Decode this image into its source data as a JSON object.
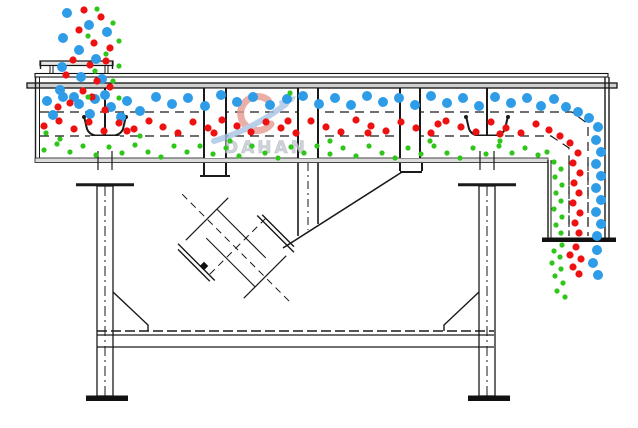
{
  "diagram": {
    "type": "linear-vibrating-screen-schematic",
    "watermark": {
      "brand": "DAHAN",
      "registered_mark": "®"
    }
  },
  "colors": {
    "line": "#1a1a1a",
    "watermark_text": "#c3c8d0",
    "watermark_red": "#e59a92",
    "watermark_blue": "#a8c4e4"
  },
  "particles": {
    "blue": {
      "radius": 5,
      "color": "#2f9ce8",
      "points": [
        [
          67,
          13
        ],
        [
          89,
          25
        ],
        [
          63,
          38
        ],
        [
          107,
          32
        ],
        [
          79,
          50
        ],
        [
          96,
          59
        ],
        [
          62,
          67
        ],
        [
          81,
          77
        ],
        [
          102,
          79
        ],
        [
          60,
          90
        ],
        [
          74,
          97
        ],
        [
          47,
          101
        ],
        [
          63,
          97
        ],
        [
          79,
          104
        ],
        [
          95,
          99
        ],
        [
          111,
          107
        ],
        [
          127,
          101
        ],
        [
          53,
          115
        ],
        [
          90,
          114
        ],
        [
          121,
          117
        ],
        [
          140,
          111
        ],
        [
          105,
          95
        ],
        [
          156,
          97
        ],
        [
          172,
          104
        ],
        [
          188,
          98
        ],
        [
          205,
          106
        ],
        [
          221,
          95
        ],
        [
          237,
          102
        ],
        [
          253,
          97
        ],
        [
          270,
          105
        ],
        [
          287,
          99
        ],
        [
          303,
          96
        ],
        [
          319,
          104
        ],
        [
          335,
          98
        ],
        [
          351,
          105
        ],
        [
          367,
          96
        ],
        [
          383,
          102
        ],
        [
          399,
          98
        ],
        [
          415,
          105
        ],
        [
          431,
          96
        ],
        [
          447,
          103
        ],
        [
          463,
          98
        ],
        [
          479,
          106
        ],
        [
          495,
          97
        ],
        [
          511,
          103
        ],
        [
          527,
          98
        ],
        [
          541,
          106
        ],
        [
          554,
          99
        ],
        [
          566,
          107
        ],
        [
          578,
          112
        ],
        [
          589,
          118
        ],
        [
          598,
          127
        ],
        [
          596,
          140
        ],
        [
          601,
          152
        ],
        [
          596,
          164
        ],
        [
          601,
          176
        ],
        [
          596,
          188
        ],
        [
          601,
          200
        ],
        [
          596,
          212
        ],
        [
          601,
          224
        ],
        [
          597,
          236
        ],
        [
          597,
          250
        ],
        [
          593,
          263
        ],
        [
          598,
          275
        ]
      ]
    },
    "red": {
      "radius": 3.6,
      "color": "#ee1111",
      "points": [
        [
          84,
          10
        ],
        [
          101,
          17
        ],
        [
          79,
          30
        ],
        [
          94,
          43
        ],
        [
          110,
          48
        ],
        [
          73,
          60
        ],
        [
          90,
          65
        ],
        [
          106,
          61
        ],
        [
          66,
          75
        ],
        [
          97,
          81
        ],
        [
          83,
          91
        ],
        [
          110,
          87
        ],
        [
          70,
          103
        ],
        [
          92,
          97
        ],
        [
          58,
          107
        ],
        [
          105,
          110
        ],
        [
          44,
          126
        ],
        [
          59,
          121
        ],
        [
          74,
          129
        ],
        [
          89,
          122
        ],
        [
          104,
          131
        ],
        [
          119,
          123
        ],
        [
          134,
          129
        ],
        [
          149,
          121
        ],
        [
          163,
          127
        ],
        [
          178,
          133
        ],
        [
          193,
          122
        ],
        [
          208,
          128
        ],
        [
          222,
          120
        ],
        [
          237,
          126
        ],
        [
          251,
          132
        ],
        [
          266,
          122
        ],
        [
          281,
          128
        ],
        [
          296,
          133
        ],
        [
          311,
          121
        ],
        [
          326,
          127
        ],
        [
          341,
          132
        ],
        [
          356,
          120
        ],
        [
          371,
          126
        ],
        [
          386,
          131
        ],
        [
          401,
          122
        ],
        [
          416,
          128
        ],
        [
          431,
          133
        ],
        [
          446,
          121
        ],
        [
          461,
          127
        ],
        [
          476,
          132
        ],
        [
          491,
          122
        ],
        [
          506,
          128
        ],
        [
          521,
          133
        ],
        [
          536,
          124
        ],
        [
          549,
          130
        ],
        [
          127,
          131
        ],
        [
          214,
          133
        ],
        [
          288,
          121
        ],
        [
          368,
          133
        ],
        [
          438,
          124
        ],
        [
          500,
          134
        ],
        [
          560,
          136
        ],
        [
          570,
          143
        ],
        [
          578,
          153
        ],
        [
          573,
          163
        ],
        [
          580,
          173
        ],
        [
          574,
          183
        ],
        [
          579,
          193
        ],
        [
          573,
          203
        ],
        [
          580,
          213
        ],
        [
          575,
          223
        ],
        [
          579,
          233
        ],
        [
          576,
          247
        ],
        [
          570,
          255
        ],
        [
          581,
          259
        ],
        [
          573,
          267
        ],
        [
          579,
          274
        ]
      ]
    },
    "green": {
      "radius": 2.6,
      "color": "#2fc51a",
      "points": [
        [
          97,
          9
        ],
        [
          113,
          23
        ],
        [
          88,
          36
        ],
        [
          119,
          41
        ],
        [
          106,
          54
        ],
        [
          119,
          66
        ],
        [
          95,
          71
        ],
        [
          113,
          81
        ],
        [
          88,
          97
        ],
        [
          119,
          98
        ],
        [
          290,
          93
        ],
        [
          44,
          150
        ],
        [
          57,
          144
        ],
        [
          70,
          152
        ],
        [
          83,
          146
        ],
        [
          96,
          155
        ],
        [
          109,
          147
        ],
        [
          122,
          153
        ],
        [
          135,
          145
        ],
        [
          148,
          152
        ],
        [
          161,
          157
        ],
        [
          174,
          146
        ],
        [
          187,
          152
        ],
        [
          200,
          146
        ],
        [
          213,
          154
        ],
        [
          226,
          148
        ],
        [
          239,
          156
        ],
        [
          252,
          146
        ],
        [
          265,
          153
        ],
        [
          278,
          158
        ],
        [
          291,
          147
        ],
        [
          304,
          153
        ],
        [
          317,
          146
        ],
        [
          330,
          154
        ],
        [
          343,
          148
        ],
        [
          356,
          156
        ],
        [
          369,
          146
        ],
        [
          382,
          153
        ],
        [
          395,
          158
        ],
        [
          408,
          148
        ],
        [
          421,
          154
        ],
        [
          434,
          146
        ],
        [
          447,
          153
        ],
        [
          460,
          158
        ],
        [
          473,
          148
        ],
        [
          486,
          154
        ],
        [
          499,
          146
        ],
        [
          512,
          153
        ],
        [
          525,
          148
        ],
        [
          538,
          155
        ],
        [
          46,
          133
        ],
        [
          60,
          139
        ],
        [
          140,
          136
        ],
        [
          230,
          141
        ],
        [
          330,
          141
        ],
        [
          430,
          141
        ],
        [
          500,
          141
        ],
        [
          547,
          152
        ],
        [
          554,
          162
        ],
        [
          561,
          169
        ],
        [
          555,
          177
        ],
        [
          562,
          185
        ],
        [
          556,
          193
        ],
        [
          561,
          201
        ],
        [
          554,
          209
        ],
        [
          562,
          217
        ],
        [
          556,
          225
        ],
        [
          561,
          233
        ],
        [
          562,
          245
        ],
        [
          554,
          251
        ],
        [
          560,
          257
        ],
        [
          552,
          263
        ],
        [
          561,
          269
        ],
        [
          555,
          276
        ],
        [
          563,
          283
        ],
        [
          557,
          291
        ],
        [
          565,
          297
        ]
      ]
    }
  }
}
